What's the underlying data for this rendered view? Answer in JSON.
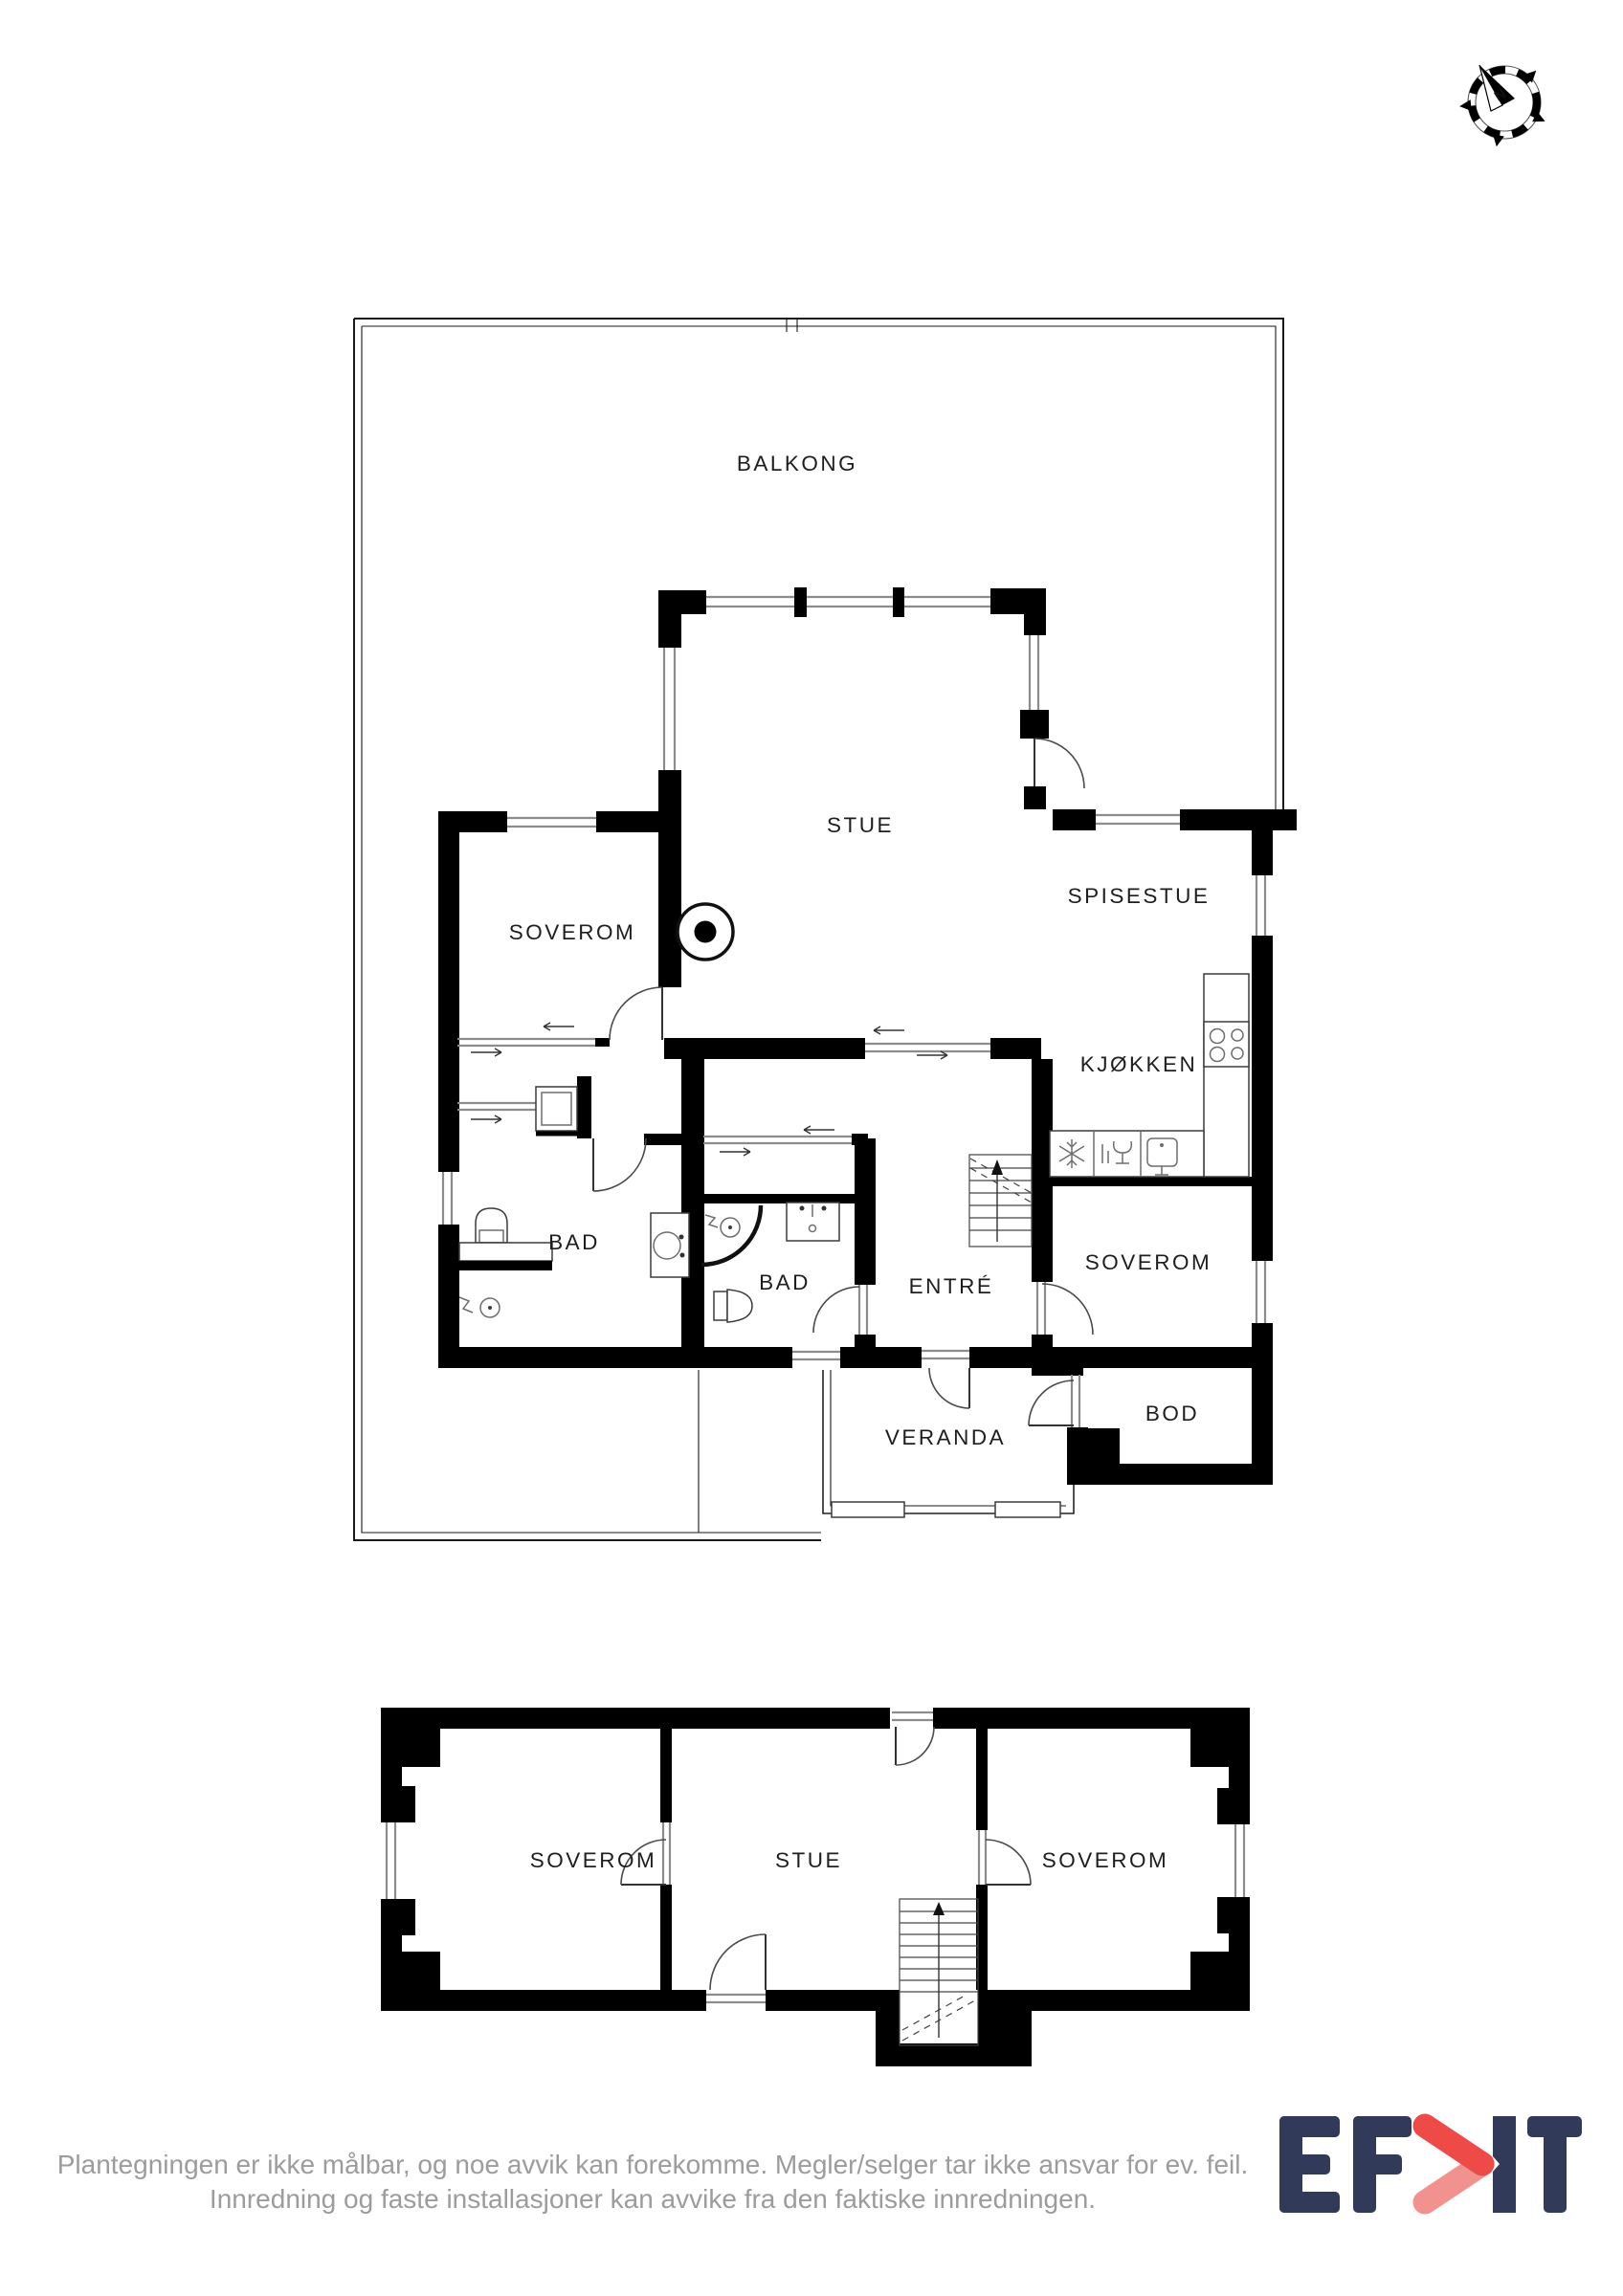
{
  "compass": {
    "north_label": "N"
  },
  "floors": {
    "main": {
      "rooms": {
        "balkong": "BALKONG",
        "stue": "STUE",
        "soverom_top": "SOVEROM",
        "spisestue": "SPISESTUE",
        "kjokken": "KJØKKEN",
        "bad_left": "BAD",
        "bad_center": "BAD",
        "entre": "ENTRÉ",
        "soverom_right": "SOVEROM",
        "bod": "BOD",
        "veranda": "VERANDA"
      }
    },
    "lower": {
      "rooms": {
        "soverom_left": "SOVEROM",
        "stue": "STUE",
        "soverom_right": "SOVEROM"
      }
    }
  },
  "footer": {
    "line1": "Plantegningen er ikke målbar, og noe avvik kan forekomme. Megler/selger tar ikke ansvar for ev. feil.",
    "line2": "Innredning og faste installasjoner kan avvike fra den faktiske innredningen."
  },
  "logo": {
    "brand": "EFKT"
  },
  "colors": {
    "wall": "#000000",
    "window_line": "#8c8c8c",
    "footer_text": "#9c9c9c",
    "logo_navy": "#323a5a",
    "logo_red": "#ee4a48",
    "logo_red_light": "#f2928e"
  }
}
